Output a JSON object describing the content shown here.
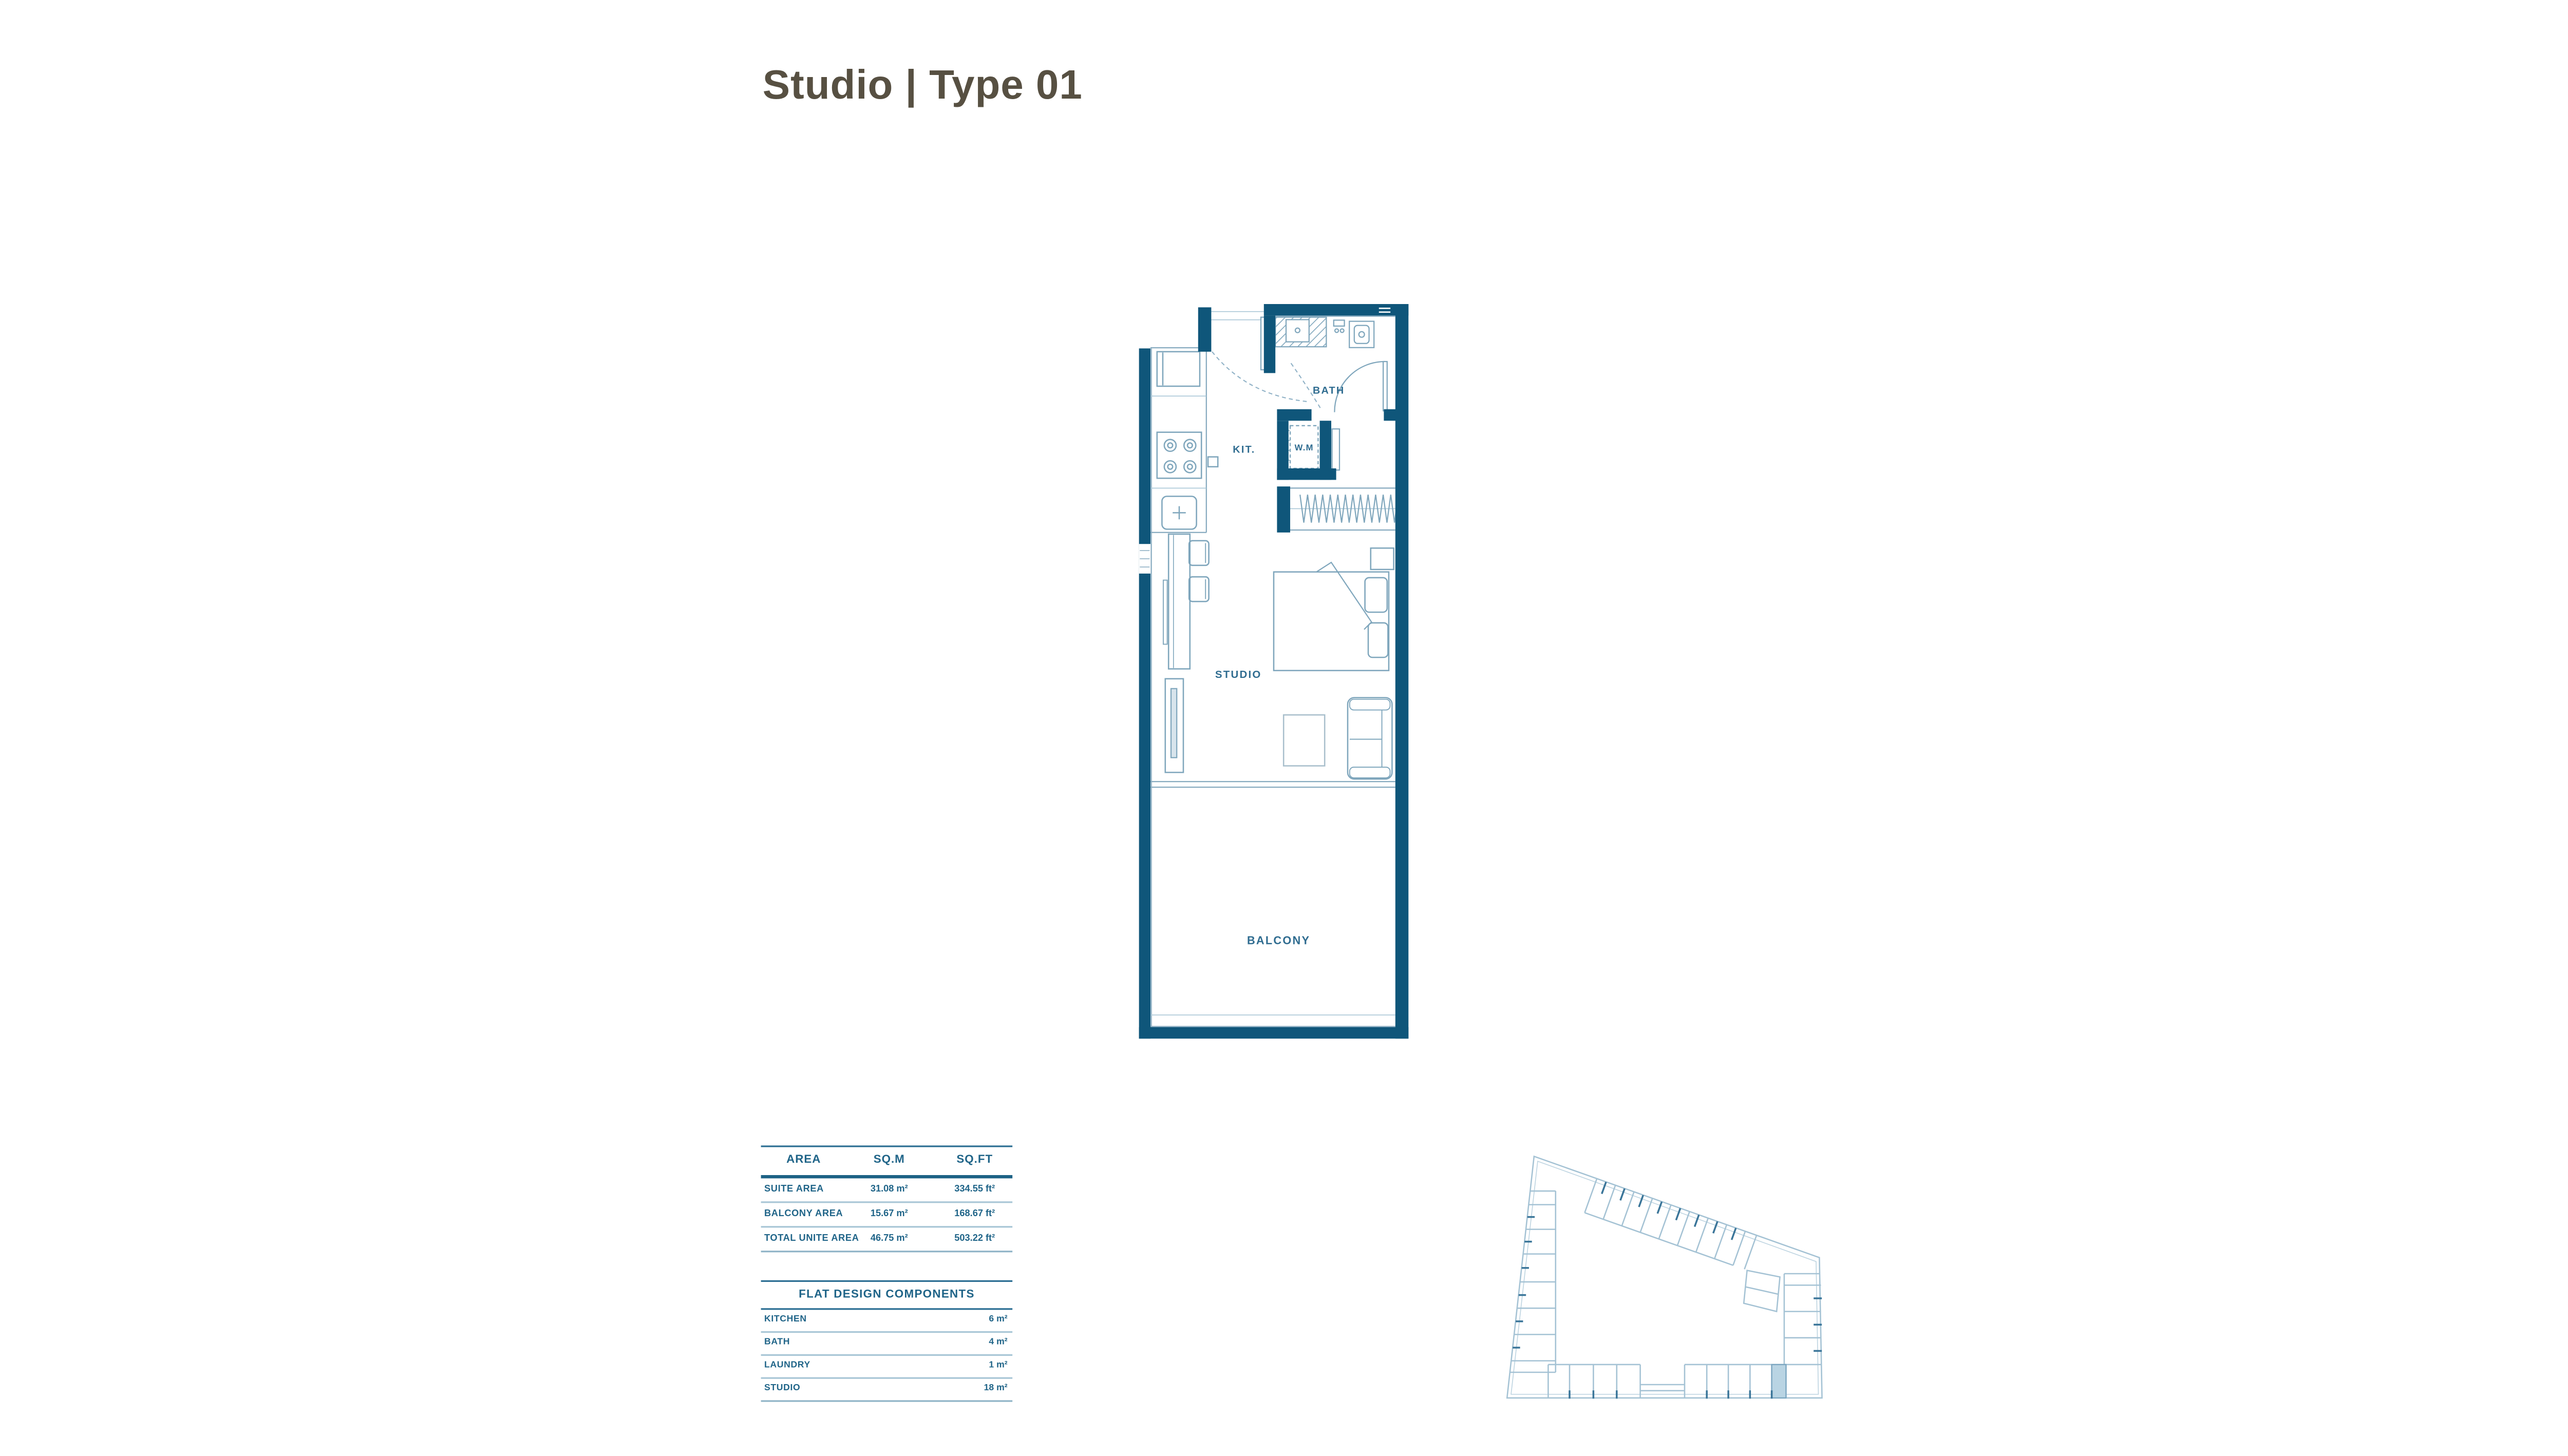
{
  "title": "Studio | Type 01",
  "colors": {
    "wall": "#0f567a",
    "fixture_line": "#7fa6bc",
    "label_text": "#2f6c90",
    "title_text": "#575042",
    "table_text": "#1f6488",
    "keyplan_line": "#a4c2d4",
    "keyplan_highlight": "#b9d4e3"
  },
  "plan": {
    "labels": {
      "bath": "BATH",
      "kitchen": "KIT.",
      "wm": "W.M",
      "studio": "STUDIO",
      "balcony": "BALCONY"
    }
  },
  "area_table": {
    "headers": [
      "AREA",
      "SQ.M",
      "SQ.FT"
    ],
    "rows": [
      {
        "label": "SUITE AREA",
        "sqm": "31.08 m²",
        "sqft": "334.55 ft²"
      },
      {
        "label": "BALCONY AREA",
        "sqm": "15.67 m²",
        "sqft": "168.67 ft²"
      },
      {
        "label": "TOTAL UNITE AREA",
        "sqm": "46.75 m²",
        "sqft": "503.22 ft²"
      }
    ]
  },
  "components_table": {
    "title": "FLAT DESIGN COMPONENTS",
    "rows": [
      {
        "label": "KITCHEN",
        "value": "6 m²"
      },
      {
        "label": "BATH",
        "value": "4 m²"
      },
      {
        "label": "LAUNDRY",
        "value": "1 m²"
      },
      {
        "label": "STUDIO",
        "value": "18 m²"
      }
    ]
  },
  "keyplan": {
    "highlighted_unit": "studio-type-01-location"
  }
}
